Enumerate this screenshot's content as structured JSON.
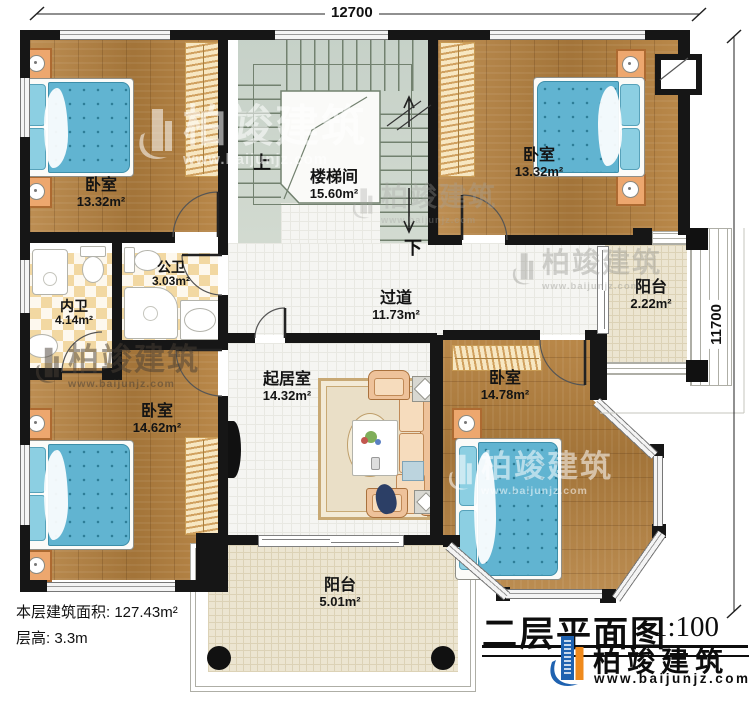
{
  "title_block": {
    "title": "二层平面图",
    "scale": "1:100",
    "brand": "柏竣建筑",
    "website": "www.baijunjz.com"
  },
  "dimensions": {
    "width": "12700",
    "height": "11700"
  },
  "notes": {
    "floor_area": "本层建筑面积: 127.43m²",
    "floor_height": "层高: 3.3m"
  },
  "stairs": {
    "up": "上",
    "down": "下"
  },
  "watermark": {
    "brand": "柏竣建筑",
    "website": "www.baijunjz.com"
  },
  "rooms": [
    {
      "id": "bedroom_top_left",
      "name": "卧室",
      "area": "13.32m²"
    },
    {
      "id": "stairwell",
      "name": "楼梯间",
      "area": "15.60m²"
    },
    {
      "id": "bedroom_top_right",
      "name": "卧室",
      "area": "13.32m²"
    },
    {
      "id": "bath_public",
      "name": "公卫",
      "area": "3.03m²"
    },
    {
      "id": "bath_private",
      "name": "内卫",
      "area": "4.14m²"
    },
    {
      "id": "hallway",
      "name": "过道",
      "area": "11.73m²"
    },
    {
      "id": "living_room",
      "name": "起居室",
      "area": "14.32m²"
    },
    {
      "id": "bedroom_bottom_left",
      "name": "卧室",
      "area": "14.62m²"
    },
    {
      "id": "bedroom_right",
      "name": "卧室",
      "area": "14.78m²"
    },
    {
      "id": "balcony_right",
      "name": "阳台",
      "area": "2.22m²"
    },
    {
      "id": "balcony_bottom",
      "name": "阳台",
      "area": "5.01m²"
    }
  ]
}
